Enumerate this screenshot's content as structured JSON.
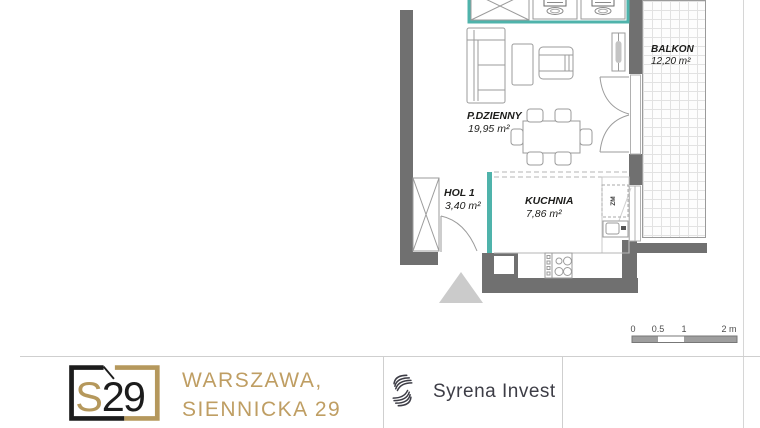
{
  "plan": {
    "rooms": [
      {
        "name": "P.DZIENNY",
        "area": "19,95 m²"
      },
      {
        "name": "HOL 1",
        "area": "3,40 m²"
      },
      {
        "name": "KUCHNIA",
        "area": "7,86 m²"
      },
      {
        "name": "BALKON",
        "area": "12,20 m²"
      }
    ],
    "labels": {
      "dishwasher": "ZM"
    },
    "scale_bar": {
      "ticks": [
        "0",
        "0.5",
        "1",
        "2 m"
      ]
    }
  },
  "footer": {
    "logo": {
      "s": "S",
      "number": "29"
    },
    "address_line1": "WARSZAWA,",
    "address_line2": "SIENNICKA 29",
    "developer": "Syrena Invest"
  },
  "colors": {
    "unit_boundary_teal": "#4fb3ab",
    "wall_gray": "#707070",
    "brand_gold": "#b5985c",
    "logo_black": "#1c1c1c",
    "developer_text": "#3d3d46"
  }
}
